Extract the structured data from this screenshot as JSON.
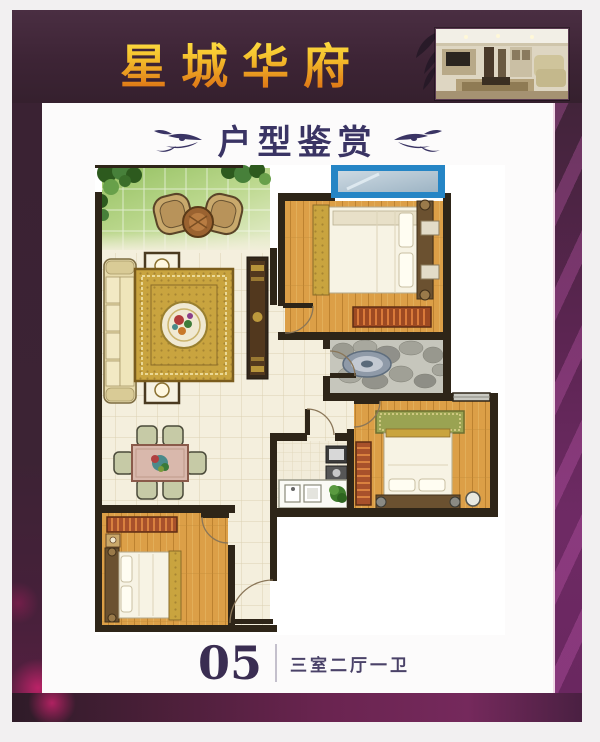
{
  "banner": {
    "title": "星城华府"
  },
  "section": {
    "heading": "户型鉴赏"
  },
  "caption": {
    "unit_number": "05",
    "layout_text": "三室二厅一卫"
  },
  "colors": {
    "banner_bg": "#3d2435",
    "title_gold": "#f5c02c",
    "heading_text": "#3a3464",
    "frame_purple": "#6e2a64",
    "accent_magenta": "#cd236e",
    "wall": "#2e2518",
    "wood_floor": "#dda04a",
    "balcony_green": "#b2d286",
    "window_blue": "#2585c5"
  },
  "floor_plan": {
    "rooms": [
      "balcony",
      "living-room",
      "dining-area",
      "master-bedroom",
      "bathroom",
      "kitchen",
      "bedroom-2",
      "bedroom-3",
      "entry-hall"
    ]
  }
}
